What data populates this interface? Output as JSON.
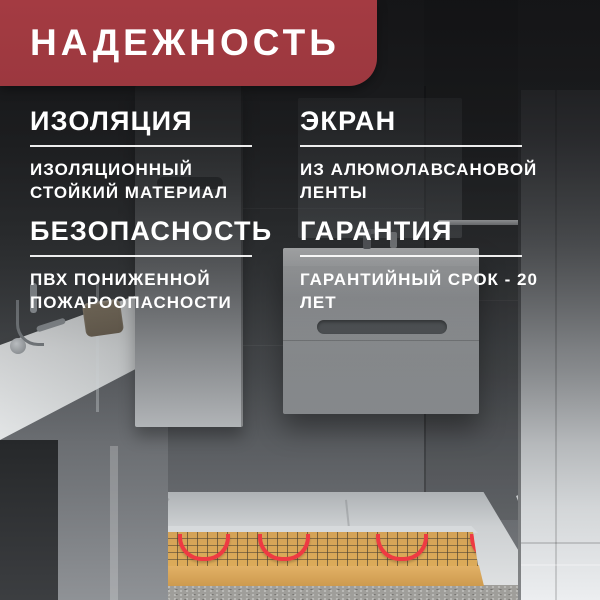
{
  "banner": {
    "title": "НАДЕЖНОСТЬ",
    "bg_color": "#a43b42",
    "text_color": "#ffffff"
  },
  "features": [
    {
      "title": "ИЗОЛЯЦИЯ",
      "description": "ИЗОЛЯЦИОННЫЙ СТОЙКИЙ МАТЕРИАЛ"
    },
    {
      "title": "ЭКРАН",
      "description": "ИЗ АЛЮМОЛАВСАНОВОЙ ЛЕНТЫ"
    },
    {
      "title": "БЕЗОПАСНОСТЬ",
      "description": "ПВХ ПОНИЖЕННОЙ ПОЖАРООПАСНОСТИ"
    },
    {
      "title": "ГАРАНТИЯ",
      "description": "ГАРАНТИЙНЫЙ СРОК - 20 ЛЕТ"
    }
  ],
  "scene": {
    "subject": "bathroom-with-heated-floor-cutaway",
    "colors": {
      "heating_cable": "#ee3a42",
      "heating_mat": "#d7a457",
      "accent_banner": "#a43b42"
    }
  }
}
